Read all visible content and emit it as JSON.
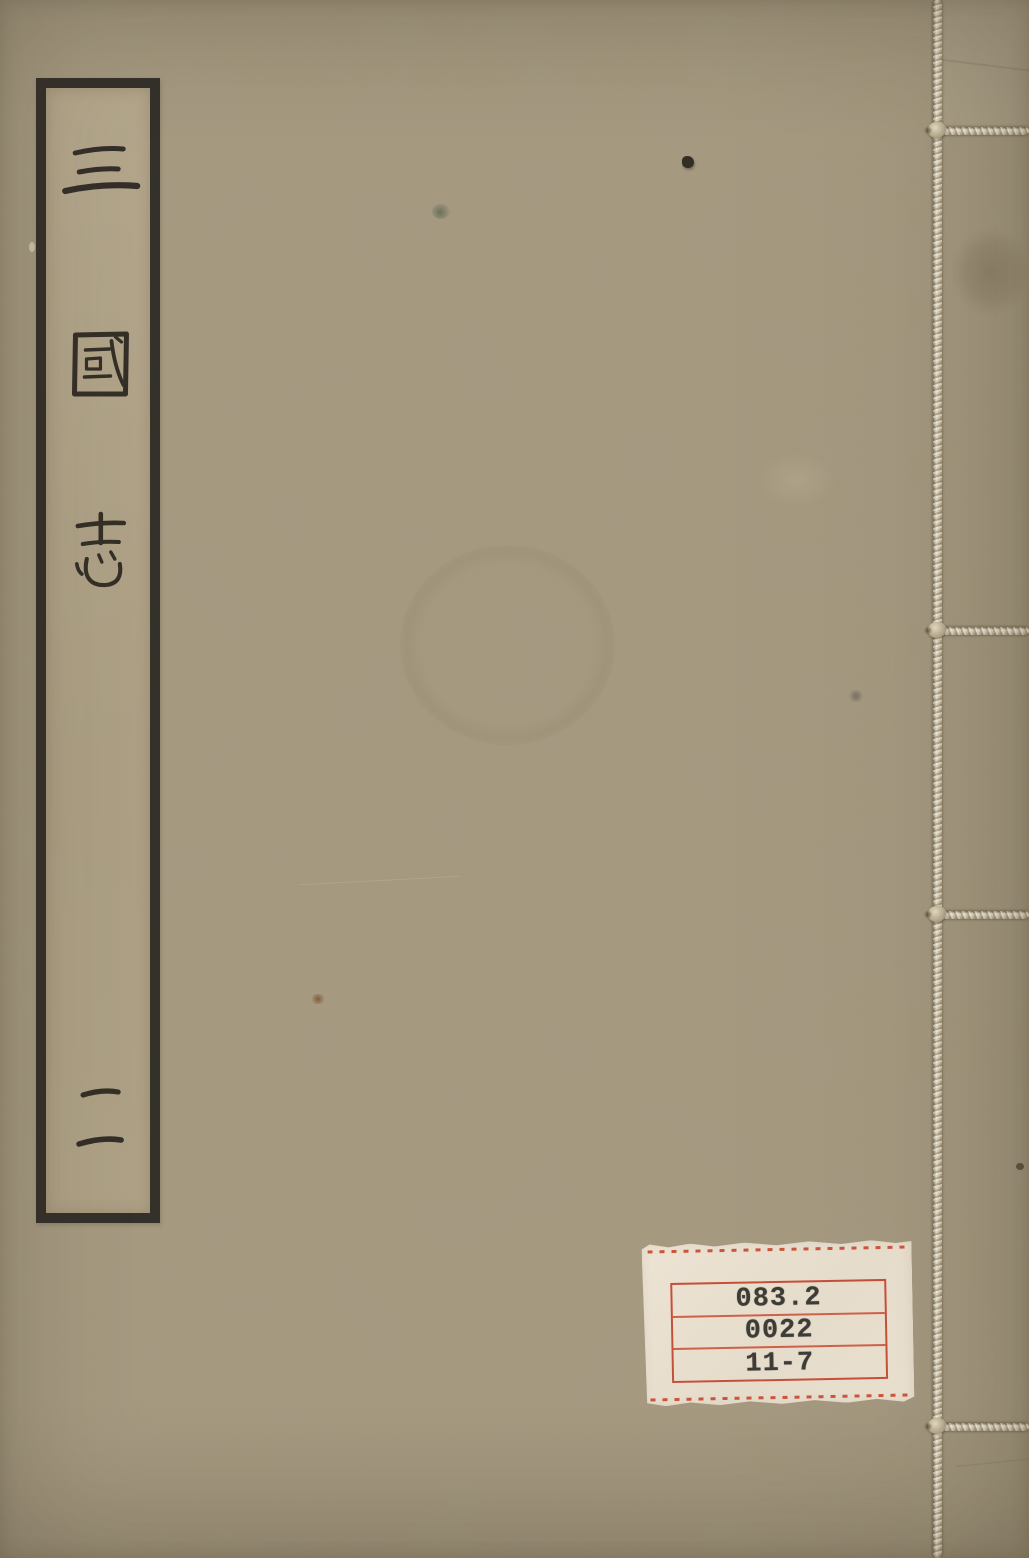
{
  "meta": {
    "description": "Photograph of a thread-bound Chinese book cover",
    "canvas": {
      "width": 1029,
      "height": 1558
    }
  },
  "cover": {
    "base_color": "#a5997f",
    "title_label": {
      "title": "三國志",
      "chars": [
        "三",
        "國",
        "志"
      ],
      "volume": "二",
      "ink_color": "#2d2822",
      "frame_color": "#34302a",
      "paper_color": "#b1a489"
    },
    "binding": {
      "thread_color": "#ddd2bb",
      "stitch_count": 4
    },
    "library_label": {
      "lines": [
        "083.2",
        "0022",
        "11-7"
      ],
      "box_color": "#c5503a",
      "paper_color": "#eae1d1",
      "ink_color": "#3d3c36"
    }
  }
}
